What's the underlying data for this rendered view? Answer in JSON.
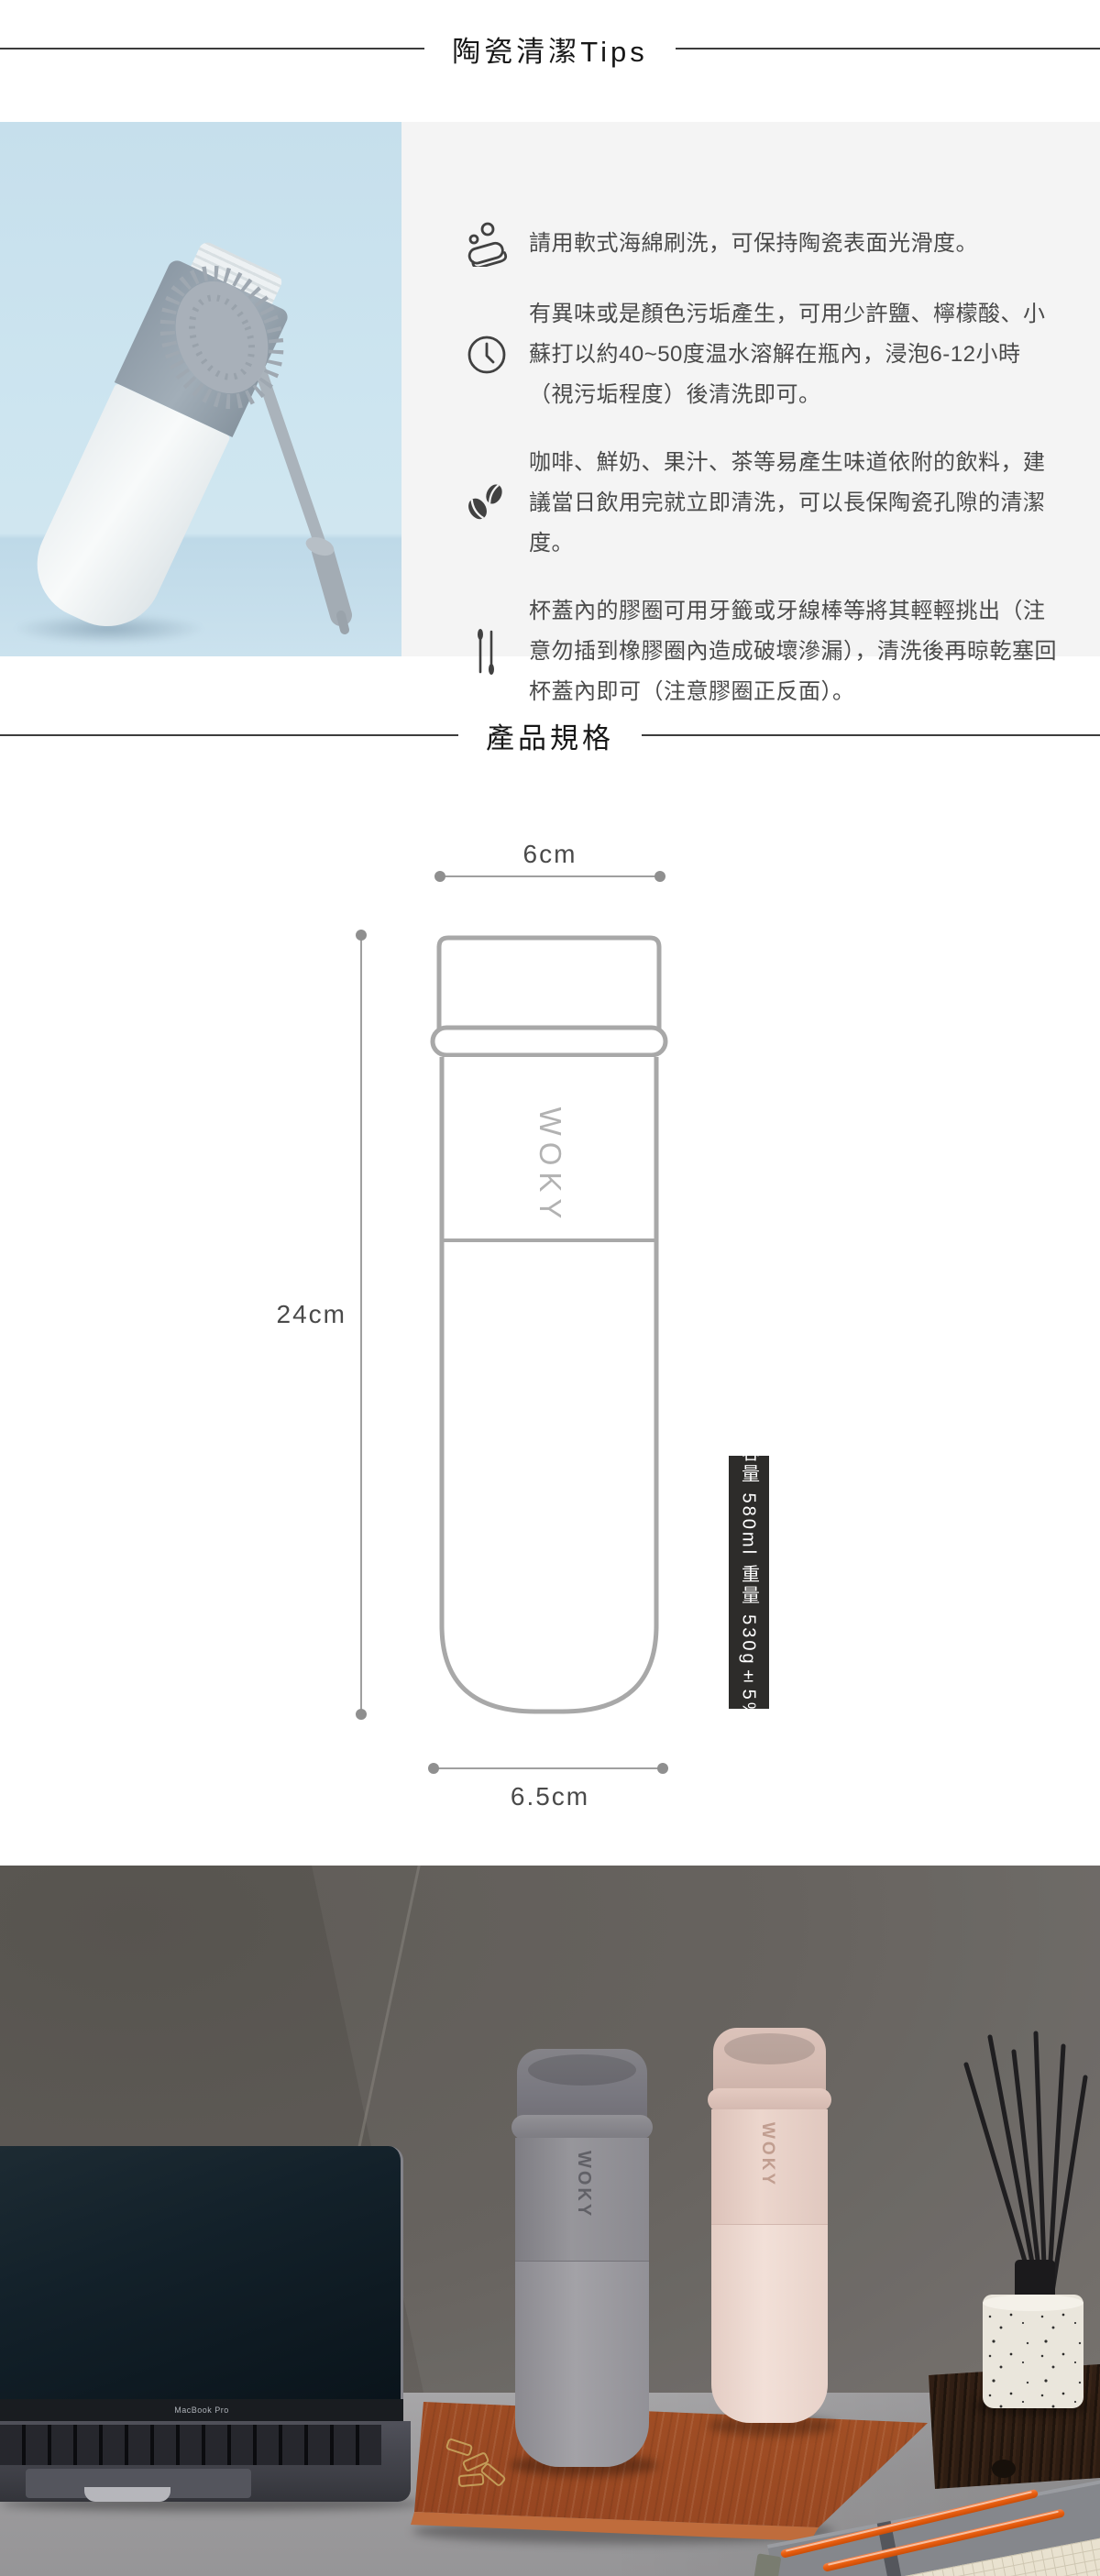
{
  "brand": "WOKY",
  "cleaning_section": {
    "title": "陶瓷清潔Tips",
    "tips": [
      {
        "icon": "sponge-icon",
        "text": "請用軟式海綿刷洗，可保持陶瓷表面光滑度。"
      },
      {
        "icon": "clock-icon",
        "text": "有異味或是顏色污垢產生，可用少許鹽、檸檬酸、小蘇打以約40~50度温水溶解在瓶內，浸泡6-12小時（視污垢程度）後清洗即可。"
      },
      {
        "icon": "coffee-beans-icon",
        "text": "咖啡、鮮奶、果汁、茶等易產生味道依附的飲料，建議當日飲用完就立即清洗，可以長保陶瓷孔隙的清潔度。"
      },
      {
        "icon": "cotton-swab-icon",
        "text": "杯蓋內的膠圈可用牙籤或牙線棒等將其輕輕挑出（注意勿插到橡膠圈內造成破壞滲漏），清洗後再晾乾塞回杯蓋內即可（注意膠圈正反面）。"
      }
    ]
  },
  "spec_section": {
    "title": "產品規格",
    "top_diameter": "6cm",
    "height": "24cm",
    "bottom_diameter": "6.5cm",
    "capacity_weight_label": "容量 580ml 重量 530g±5%"
  },
  "photo_section": {
    "laptop_label": "MacBook Pro"
  },
  "colors": {
    "tips_panel_bg": "#f4f4f4",
    "tips_photo_bg": "#cbe3ee",
    "diagram_line": "#9f9f9f",
    "capacity_tag_bg": "#2d2c2a",
    "body_text": "#4a4a4a",
    "tray_wood": "#a85427",
    "bottle_gray": "#908f93",
    "bottle_pink": "#e7d1c8",
    "pen_orange": "#ea5f10"
  }
}
